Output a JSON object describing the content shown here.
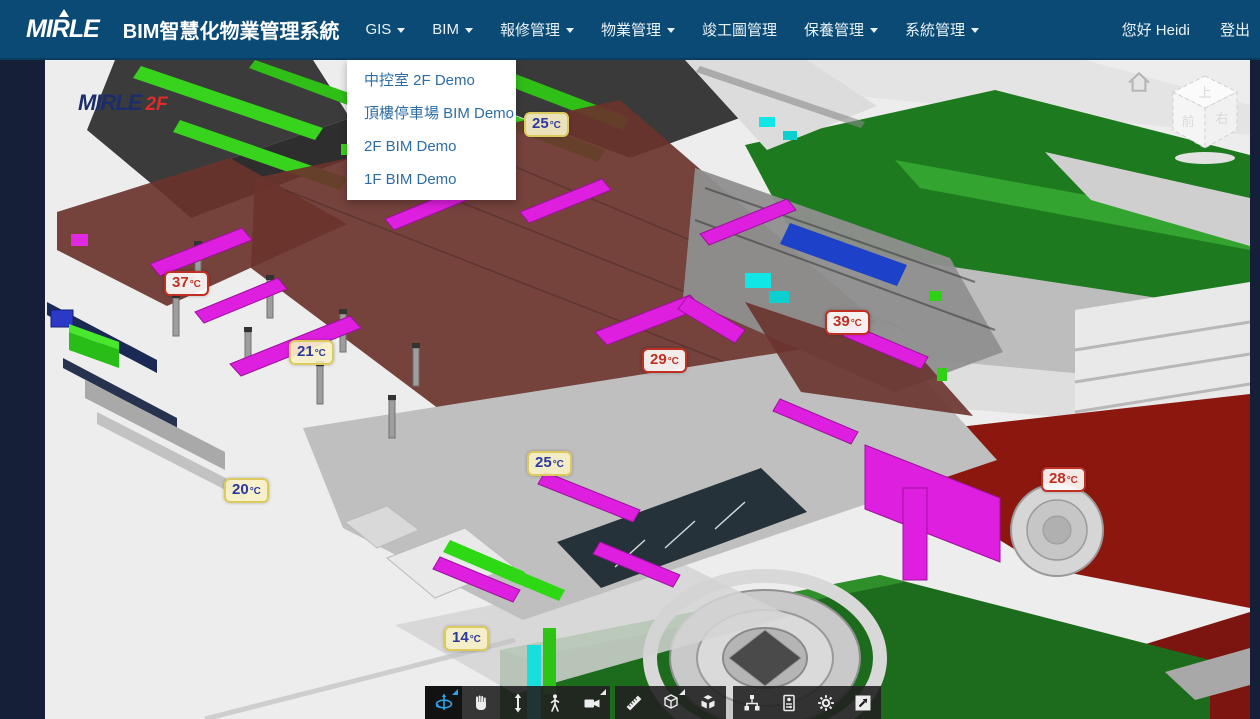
{
  "navbar": {
    "brand": "MIRLE",
    "title": "BIM智慧化物業管理系統",
    "menu": [
      {
        "label": "GIS",
        "caret": true
      },
      {
        "label": "BIM",
        "caret": true
      },
      {
        "label": "報修管理",
        "caret": true
      },
      {
        "label": "物業管理",
        "caret": true
      },
      {
        "label": "竣工圖管理",
        "caret": false
      },
      {
        "label": "保養管理",
        "caret": true
      },
      {
        "label": "系統管理",
        "caret": true
      }
    ],
    "greeting": "您好 Heidi",
    "logout": "登出"
  },
  "dropdown": {
    "parent": "BIM",
    "items": [
      {
        "label": "中控室 2F Demo"
      },
      {
        "label": "頂樓停車場 BIM Demo"
      },
      {
        "label": "2F BIM Demo"
      },
      {
        "label": "1F BIM Demo"
      }
    ]
  },
  "viewer": {
    "watermark": {
      "brand": "MIRLE",
      "floor": "2F"
    },
    "nav_cube": {
      "top": "上",
      "front": "前",
      "right": "右"
    },
    "temperature_labels": [
      {
        "num": "25",
        "unit": "°C",
        "state": "cool"
      },
      {
        "num": "37",
        "unit": "°C",
        "state": "alarm"
      },
      {
        "num": "21",
        "unit": "°C",
        "state": "cool"
      },
      {
        "num": "39",
        "unit": "°C",
        "state": "alarm"
      },
      {
        "num": "29",
        "unit": "°C",
        "state": "alarm"
      },
      {
        "num": "25",
        "unit": "°C",
        "state": "cool"
      },
      {
        "num": "20",
        "unit": "°C",
        "state": "cool"
      },
      {
        "num": "28",
        "unit": "°C",
        "state": "alarm"
      },
      {
        "num": "14",
        "unit": "°C",
        "state": "cool"
      }
    ],
    "toolbar": {
      "buttons": [
        {
          "name": "orbit",
          "active": true,
          "flyout": "blue"
        },
        {
          "name": "pan",
          "active": false
        },
        {
          "name": "zoom",
          "active": false
        },
        {
          "name": "walk",
          "active": false
        },
        {
          "name": "camera",
          "active": false,
          "flyout": "white"
        },
        {
          "name": "measure",
          "active": false
        },
        {
          "name": "section",
          "active": false,
          "flyout": "white"
        },
        {
          "name": "explode",
          "active": false
        },
        {
          "name": "model-tree",
          "active": false
        },
        {
          "name": "properties",
          "active": false
        },
        {
          "name": "settings",
          "active": false
        },
        {
          "name": "fullscreen",
          "active": false
        }
      ]
    },
    "colors": {
      "navbar": "#0a4a74",
      "edge_strip": "#152038",
      "alarm_red": "#c03022",
      "cool_blue": "#2c3a9e",
      "cool_bg": "#f6f0c8",
      "duct_magenta": "#df1fdf",
      "duct_lime": "#38d41d",
      "floor_red": "#6a332c",
      "terrain_green": "#1d7a1e",
      "road_dark_red": "#8c170f",
      "active_tool_blue": "#2aa3e8"
    }
  }
}
